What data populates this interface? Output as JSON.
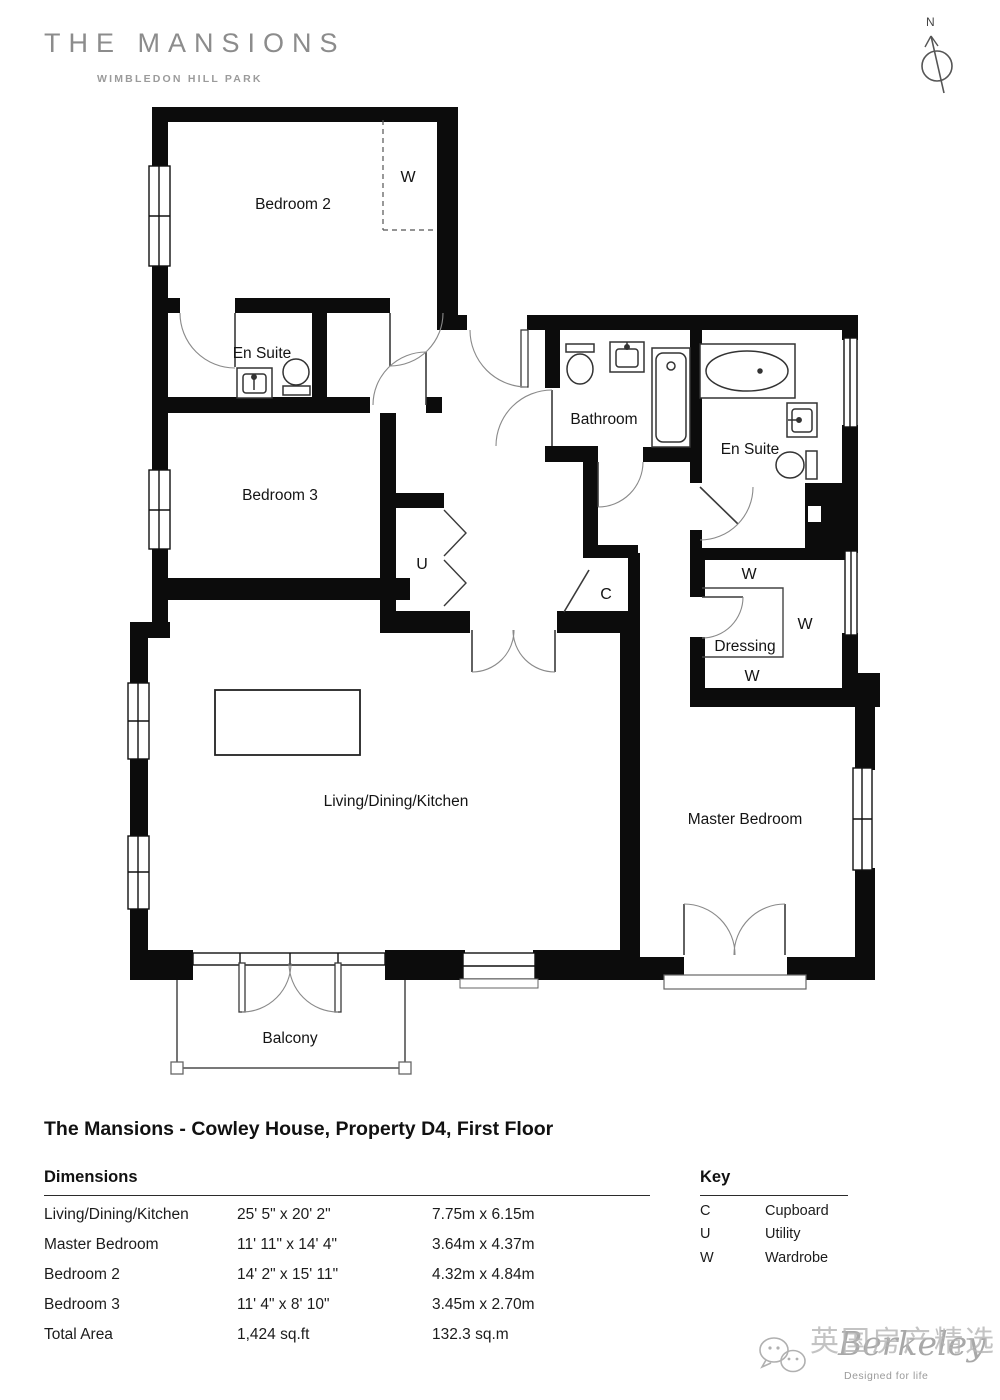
{
  "branding": {
    "name": "THE MANSIONS",
    "subtitle": "WIMBLEDON HILL PARK"
  },
  "compass": {
    "label": "N"
  },
  "floorplan": {
    "rooms": {
      "bedroom2": "Bedroom 2",
      "ensuite2": "En Suite",
      "bedroom3": "Bedroom 3",
      "bathroom": "Bathroom",
      "master_ensuite": "En Suite",
      "dressing": "Dressing",
      "living": "Living/Dining/Kitchen",
      "master": "Master Bedroom",
      "balcony": "Balcony"
    },
    "markers": {
      "wardrobe": "W",
      "utility": "U",
      "cupboard": "C"
    }
  },
  "title": "The Mansions - Cowley House, Property D4, First Floor",
  "dimensions": {
    "heading": "Dimensions",
    "rows": [
      {
        "room": "Living/Dining/Kitchen",
        "imperial": "25' 5\" x 20' 2\"",
        "metric": "7.75m x 6.15m"
      },
      {
        "room": "Master Bedroom",
        "imperial": "11' 11\" x 14' 4\"",
        "metric": "3.64m x 4.37m"
      },
      {
        "room": "Bedroom 2",
        "imperial": "14' 2\" x 15' 11\"",
        "metric": "4.32m x 4.84m"
      },
      {
        "room": "Bedroom 3",
        "imperial": "11' 4\" x 8' 10\"",
        "metric": "3.45m x 2.70m"
      },
      {
        "room": "Total Area",
        "imperial": "1,424 sq.ft",
        "metric": "132.3 sq.m"
      }
    ]
  },
  "key": {
    "heading": "Key",
    "rows": [
      {
        "abbr": "C",
        "label": "Cupboard"
      },
      {
        "abbr": "U",
        "label": "Utility"
      },
      {
        "abbr": "W",
        "label": "Wardrobe"
      }
    ]
  },
  "watermark": {
    "logo": "Berkeley",
    "tagline": "Designed for life",
    "overlay": "英国房产精选"
  }
}
